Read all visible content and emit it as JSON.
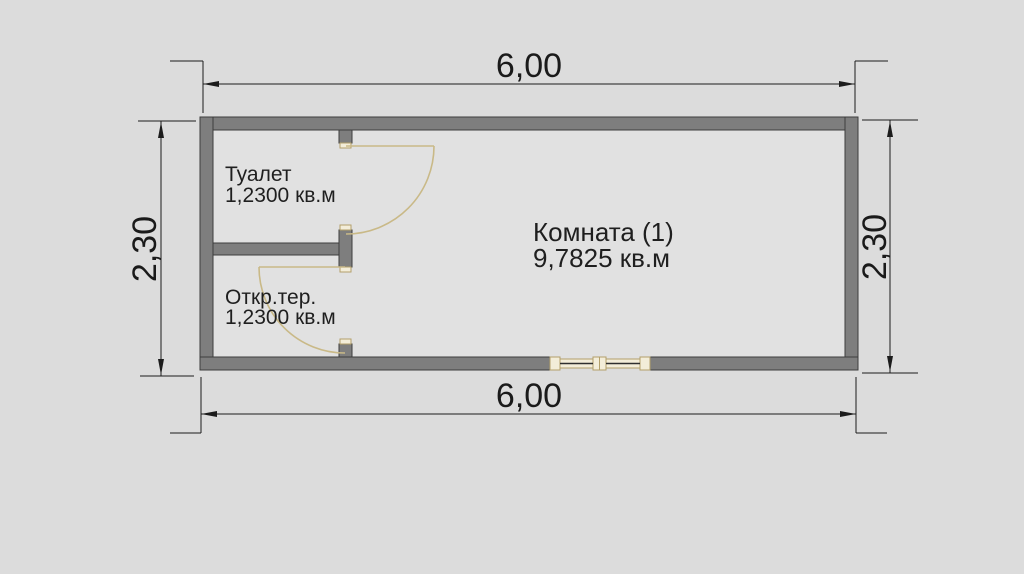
{
  "dimensions": {
    "top": "6,00",
    "bottom": "6,00",
    "left": "2,30",
    "right": "2,30"
  },
  "rooms": {
    "toilet": {
      "name": "Туалет",
      "area": "1,2300 кв.м"
    },
    "terrace": {
      "name": "Откр.тер.",
      "area": "1,2300 кв.м"
    },
    "main": {
      "name": "Комната (1)",
      "area": "9,7825 кв.м"
    }
  },
  "colors": {
    "background": "#dcdcdc",
    "wall_fill": "#7e7e7e",
    "wall_outline": "#3d3d3d",
    "dimension_lines": "#1c1c1c",
    "door_swing": "#c9b987",
    "window_fill": "#f3edd9",
    "window_frame": "#b3a06a"
  }
}
